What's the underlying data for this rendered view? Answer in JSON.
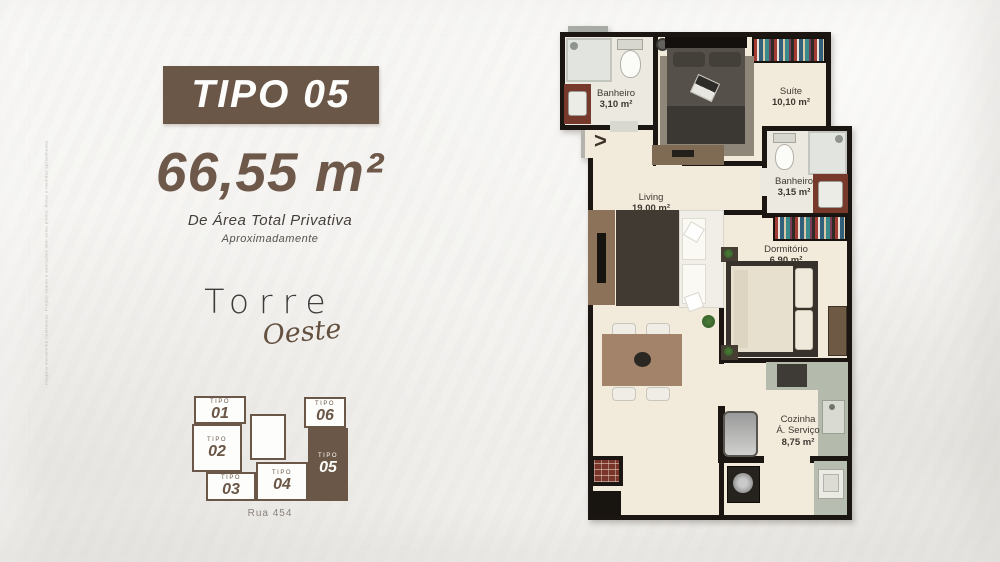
{
  "page": {
    "background": "#f4f3f0"
  },
  "left_panel": {
    "badge": "TIPO 05",
    "area_value": "66,55 m²",
    "area_label": "De Área Total Privativa",
    "area_sublabel": "Aproximadamente",
    "brand_line1": "Torre",
    "brand_line2": "Oeste",
    "disclaimer": "Imagens meramente ilustrativas. Projeto sujeito a alterações sem aviso prévio. Áreas e medidas aproximadas."
  },
  "keyplan": {
    "street": "Rua 454",
    "units": [
      {
        "tipo": "TIPO",
        "num": "01",
        "selected": false
      },
      {
        "tipo": "TIPO",
        "num": "02",
        "selected": false
      },
      {
        "tipo": "TIPO",
        "num": "03",
        "selected": false
      },
      {
        "tipo": "TIPO",
        "num": "04",
        "selected": false
      },
      {
        "tipo": "TIPO",
        "num": "05",
        "selected": true
      },
      {
        "tipo": "TIPO",
        "num": "06",
        "selected": false
      }
    ]
  },
  "floorplan": {
    "entry_marker": ">",
    "rooms": {
      "banheiro1": {
        "name": "Banheiro",
        "area": "3,10 m²"
      },
      "suite": {
        "name": "Suíte",
        "area": "10,10 m²"
      },
      "banheiro2": {
        "name": "Banheiro",
        "area": "3,15 m²"
      },
      "living": {
        "name": "Living",
        "area": "19,00 m²"
      },
      "dormitorio": {
        "name": "Dormitório",
        "area": "6,90 m²"
      },
      "cozinha": {
        "name": "Cozinha",
        "line2": "Á. Serviço",
        "area": "8,75 m²"
      }
    }
  },
  "colors": {
    "accent_brown": "#6b5748",
    "wall_black": "#1b1612",
    "floor_cream": "#f2ebdc",
    "counter_green": "#b4bbac",
    "vanity_red": "#76392b"
  }
}
